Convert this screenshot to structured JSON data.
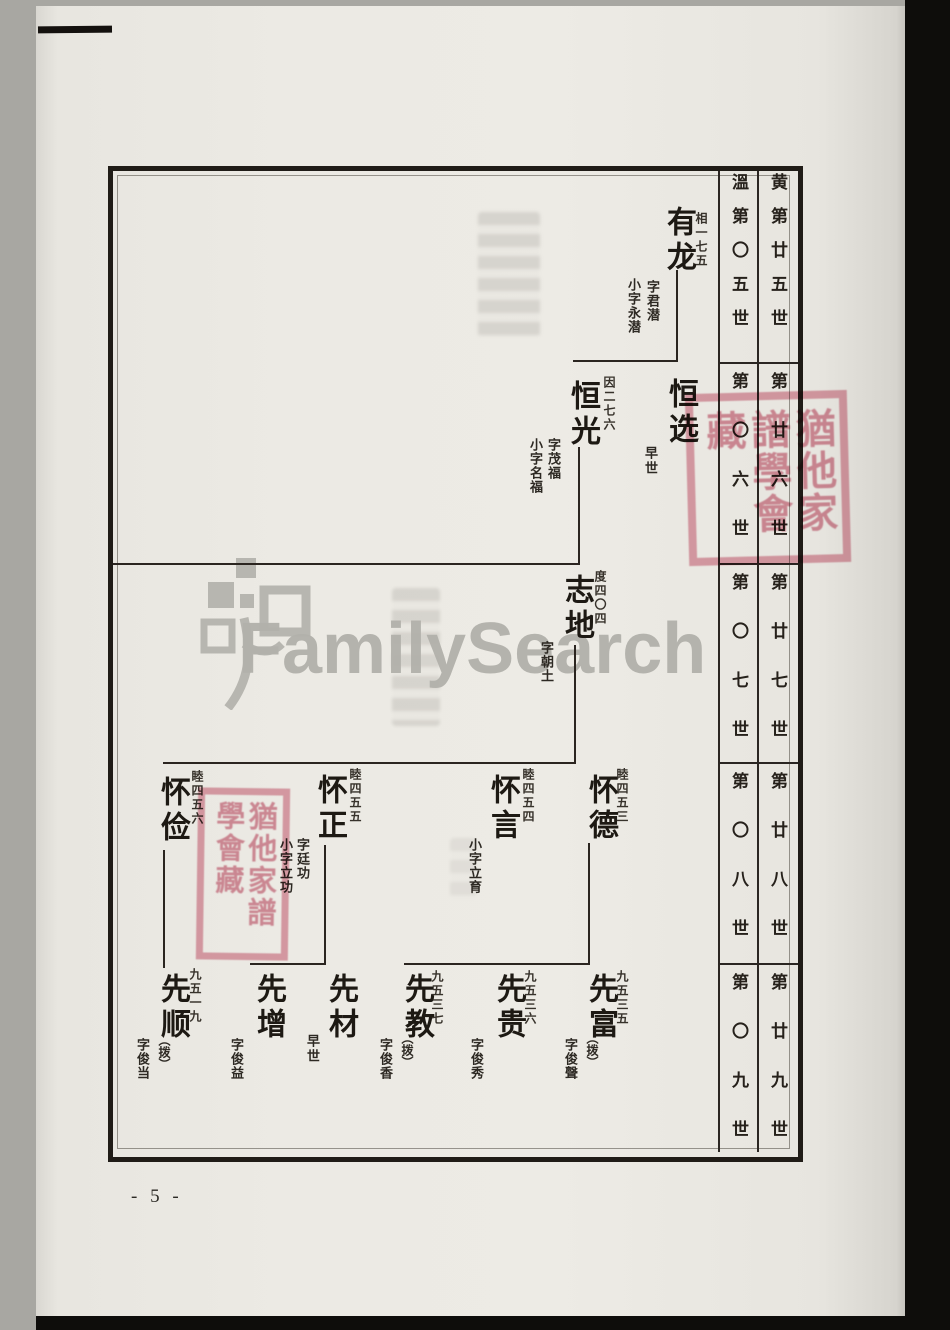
{
  "page": {
    "number_label": "- 5 -"
  },
  "watermark": {
    "text": "FamilySearch"
  },
  "seals": {
    "text": "猶他家譜學會藏"
  },
  "generation_table": {
    "columns": [
      {
        "surname": "黄",
        "first_cell": "黄第廿五世",
        "cells": [
          "第廿六世",
          "第廿七世",
          "第廿八世",
          "第廿九世"
        ]
      },
      {
        "surname": "溫",
        "first_cell": "溫第〇五世",
        "cells": [
          "第〇六世",
          "第〇七世",
          "第〇八世",
          "第〇九世"
        ]
      }
    ]
  },
  "tree": {
    "nodes": [
      {
        "name": "有龙",
        "ref": "相一七五",
        "zi": "字君潜",
        "xiaozi": "小字永潜"
      },
      {
        "name": "恒选",
        "note": "早世"
      },
      {
        "name": "恒光",
        "ref": "因二七六",
        "zi": "字茂福",
        "xiaozi": "小字名福"
      },
      {
        "name": "志地",
        "ref": "度四〇四",
        "zi": "字朝土"
      },
      {
        "name": "怀德",
        "ref": "睦四五三"
      },
      {
        "name": "怀言",
        "ref": "睦四五四",
        "xiaozi": "小字立育"
      },
      {
        "name": "怀正",
        "ref": "睦四五五",
        "zi": "字廷功",
        "xiaozi": "小字立功"
      },
      {
        "name": "怀俭",
        "ref": "睦四五六"
      },
      {
        "name": "先富",
        "tag": "︵拨︶",
        "ref": "九五三五",
        "zi": "字俊聲"
      },
      {
        "name": "先贵",
        "ref": "九五三六",
        "zi": "字俊秀"
      },
      {
        "name": "先教",
        "tag": "︵拨︶",
        "ref": "九五三七",
        "zi": "字俊香"
      },
      {
        "name": "先材",
        "note": "早世"
      },
      {
        "name": "先增",
        "zi": "字俊益"
      },
      {
        "name": "先顺",
        "tag": "︵拨︶",
        "ref": "九五一九",
        "zi": "字俊当"
      }
    ]
  }
}
